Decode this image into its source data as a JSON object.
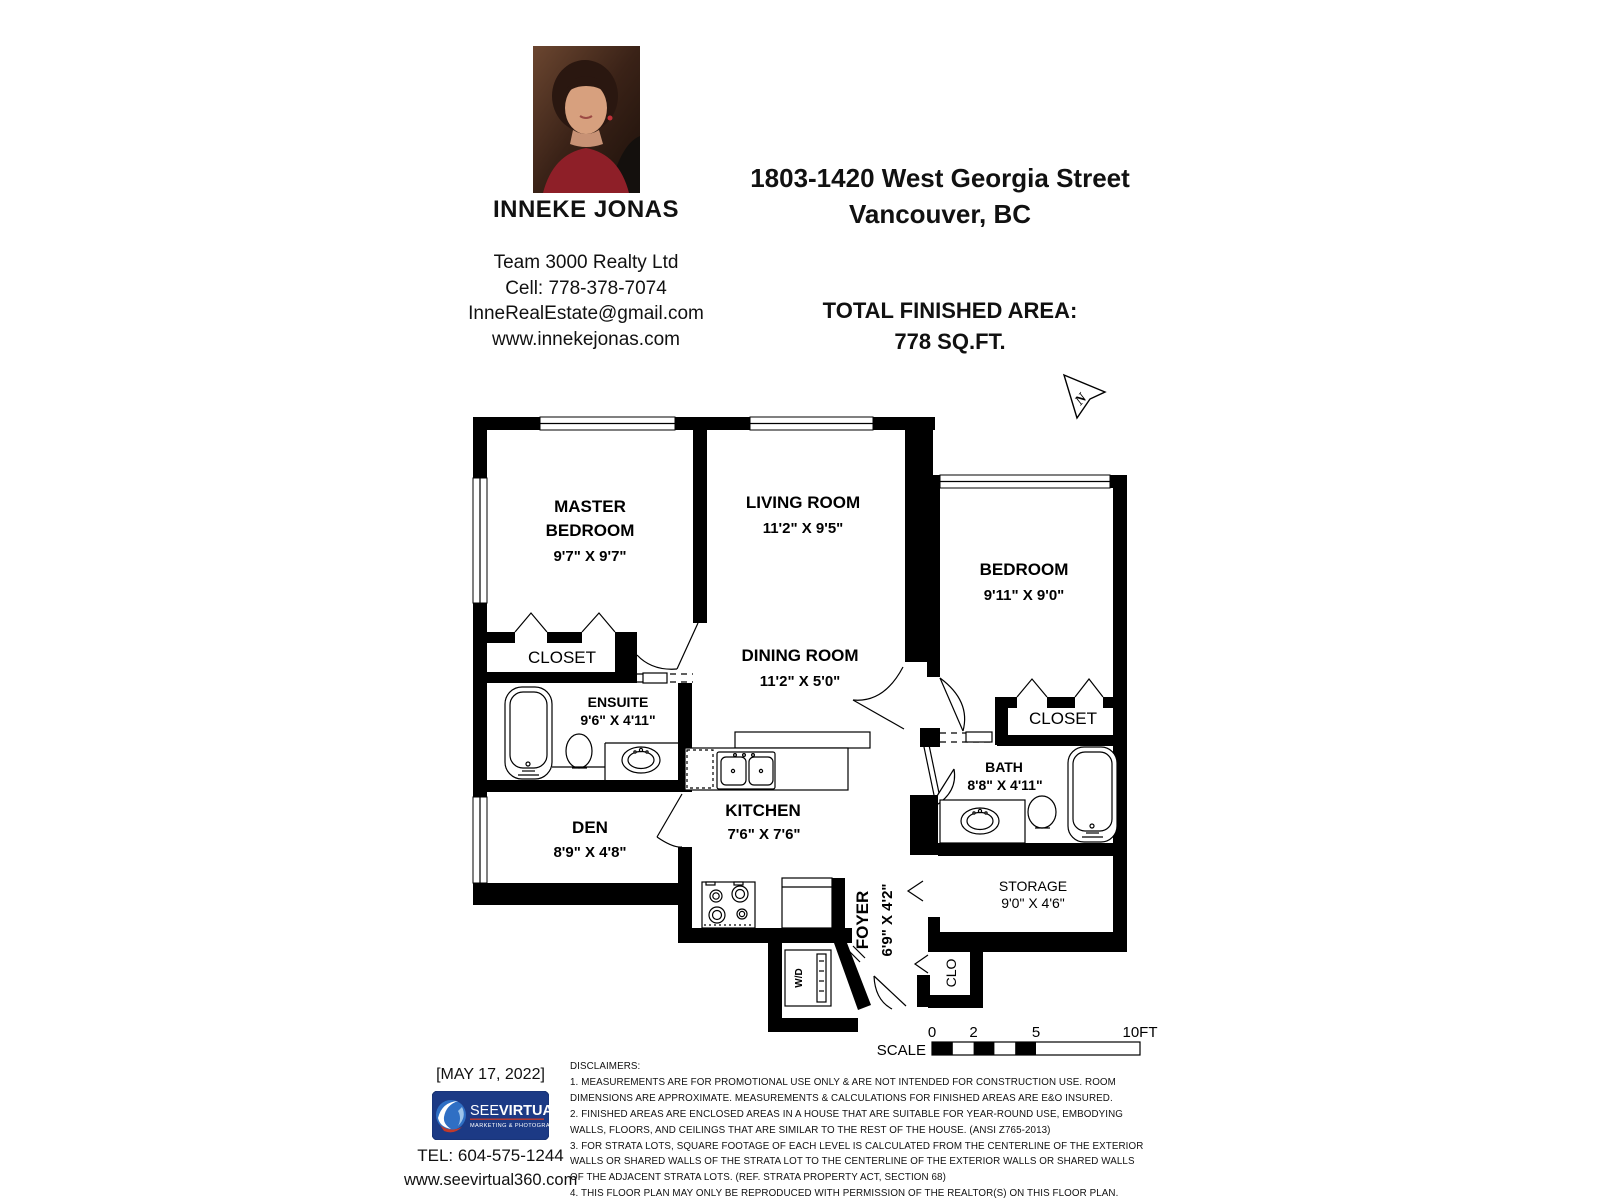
{
  "header": {
    "agent_name": "INNEKE JONAS",
    "company": "Team 3000 Realty Ltd",
    "cell": "Cell: 778-378-7074",
    "email": "InneRealEstate@gmail.com",
    "website": "www.innekejonas.com",
    "address_line1": "1803-1420 West Georgia Street",
    "address_line2": "Vancouver, BC",
    "area_label": "TOTAL FINISHED AREA:",
    "area_value": "778 SQ.FT."
  },
  "floorplan": {
    "north": "N",
    "rooms": {
      "master_1": "MASTER",
      "master_2": "BEDROOM",
      "master_dims": "9'7\" X 9'7\"",
      "living": "LIVING ROOM",
      "living_dims": "11'2\" X 9'5\"",
      "bedroom": "BEDROOM",
      "bedroom_dims": "9'11\" X 9'0\"",
      "dining": "DINING ROOM",
      "dining_dims": "11'2\" X 5'0\"",
      "closet_master": "CLOSET",
      "closet_bedroom": "CLOSET",
      "ensuite": "ENSUITE",
      "ensuite_dims": "9'6\" X 4'11\"",
      "bath": "BATH",
      "bath_dims": "8'8\" X 4'11\"",
      "den": "DEN",
      "den_dims": "8'9\" X 4'8\"",
      "kitchen": "KITCHEN",
      "kitchen_dims": "7'6\" X 7'6\"",
      "storage": "STORAGE",
      "storage_dims": "9'0\" X 4'6\"",
      "foyer": "FOYER",
      "foyer_dims": "6'9\" X 4'2\"",
      "clo": "CLO",
      "wd": "W/D"
    },
    "scale": {
      "label": "SCALE",
      "ticks": [
        "0",
        "2",
        "5",
        "10FT"
      ]
    }
  },
  "footer": {
    "date": "[MAY 17, 2022]",
    "logo_see": "SEE",
    "logo_virtual": "VIRTUAL",
    "logo_sub": "MARKETING & PHOTOGRAPHY",
    "tel": "TEL: 604-575-1244",
    "website": "www.seevirtual360.com"
  },
  "disclaimers": {
    "title": "DISCLAIMERS:",
    "items": [
      "1. MEASUREMENTS ARE FOR PROMOTIONAL USE ONLY & ARE NOT INTENDED FOR CONSTRUCTION USE. ROOM DIMENSIONS ARE APPROXIMATE. MEASUREMENTS & CALCULATIONS FOR FINISHED AREAS ARE E&O INSURED.",
      "2. FINISHED AREAS ARE ENCLOSED AREAS IN A HOUSE THAT ARE SUITABLE FOR YEAR-ROUND USE, EMBODYING WALLS, FLOORS, AND CEILINGS THAT ARE SIMILAR TO THE REST OF THE HOUSE. (ANSI Z765-2013)",
      "3. FOR STRATA LOTS, SQUARE FOOTAGE OF EACH LEVEL IS CALCULATED FROM THE CENTERLINE OF THE EXTERIOR WALLS OR SHARED WALLS OF THE STRATA LOT TO THE CENTERLINE OF THE EXTERIOR WALLS OR SHARED WALLS OF THE ADJACENT STRATA LOTS. (REF. STRATA PROPERTY ACT, SECTION 68)",
      "4. THIS FLOOR PLAN MAY ONLY BE REPRODUCED WITH PERMISSION OF THE REALTOR(S) ON THIS FLOOR PLAN.",
      "* ANY MEASUREMENTS WITH AN ASTERISK (*) ARE APPROXIMATE AND FOR ILLUSTRATION PURPOSES ONLY AND ARE NOT E&O INSURED."
    ]
  }
}
